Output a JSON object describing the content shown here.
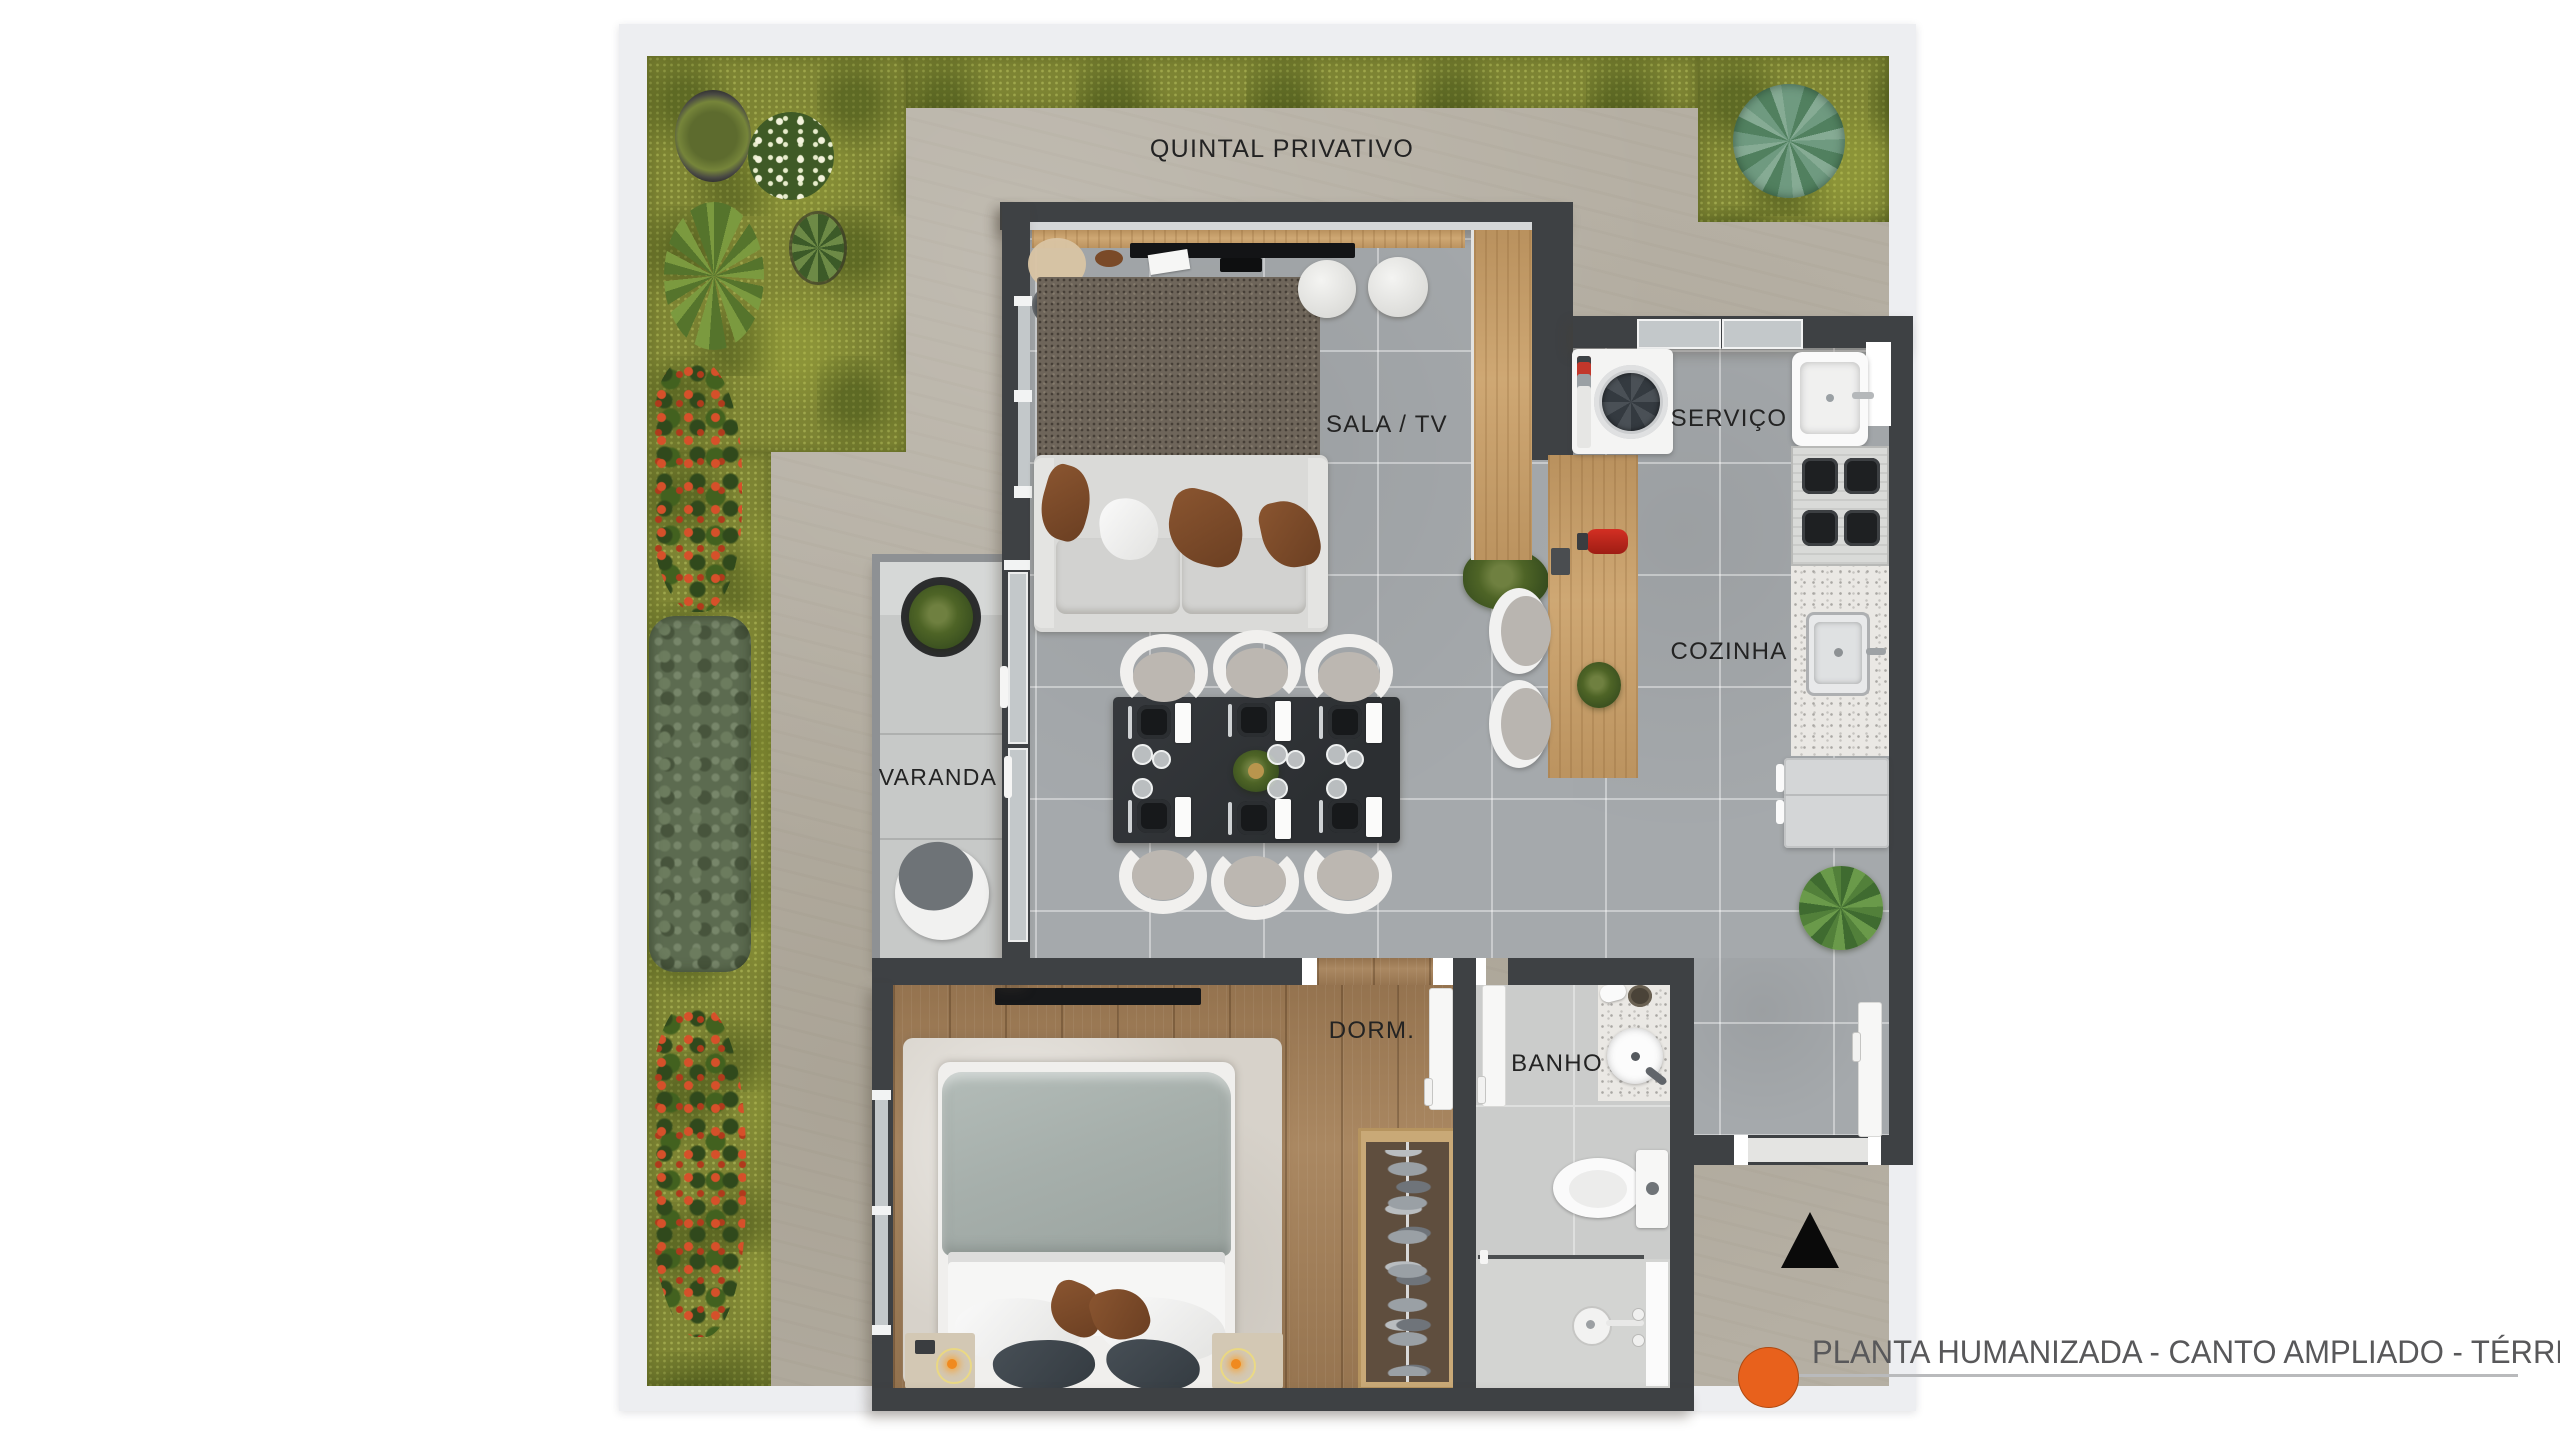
{
  "plan": {
    "rooms": [
      {
        "id": "quintal",
        "label": "QUINTAL PRIVATIVO"
      },
      {
        "id": "sala",
        "label": "SALA / TV"
      },
      {
        "id": "servico",
        "label": "SERVIÇO"
      },
      {
        "id": "cozinha",
        "label": "COZINHA"
      },
      {
        "id": "varanda",
        "label": "VARANDA"
      },
      {
        "id": "dorm",
        "label": "DORM."
      },
      {
        "id": "banho",
        "label": "BANHO"
      }
    ],
    "colors": {
      "wall": "#3E4144",
      "floor_tile": "#A5A9AC",
      "patio": "#B5AFA3",
      "grass": "#7D8433",
      "wood_counter": "#C9A06A",
      "bedroom_floor": "#A3805A",
      "accent_orange": "#E8611C",
      "title_text": "#58585A"
    },
    "compass": {
      "icon": "north-arrow-icon"
    }
  },
  "legend": {
    "title": "PLANTA HUMANIZADA - CANTO AMPLIADO - TÉRREO",
    "bullet_color": "#E8611C"
  }
}
